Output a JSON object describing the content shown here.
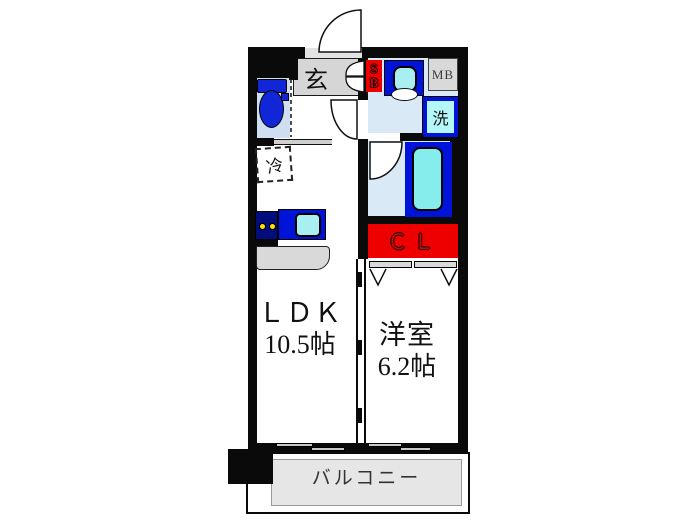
{
  "rooms": {
    "ldk": {
      "name": "ＬＤＫ",
      "area": "10.5帖"
    },
    "western": {
      "name": "洋室",
      "area": "6.2帖"
    },
    "balcony": {
      "name": "バルコニー"
    },
    "entrance": {
      "name": "玄"
    },
    "closet": {
      "name": "ＣＬ"
    },
    "meter_box": {
      "name": "MB"
    },
    "laundry": {
      "name": "洗"
    },
    "fridge": {
      "name": "冷"
    },
    "shoe_box": {
      "top": "S",
      "bottom": "B"
    }
  },
  "colors": {
    "wall": "#0a0a0a",
    "wet_room_fill": "#d9e9f6",
    "toilet_room_fill": "#cfdff1",
    "fixture_blue": "#0013d9",
    "fixture_cyan": "#a9eff2",
    "accent_red": "#ee0000",
    "genkan_gray": "#d6d6d6",
    "balcony_gray": "#e6e6e6",
    "stove_navy": "#000d7a",
    "burner_yellow": "#ffe400"
  }
}
